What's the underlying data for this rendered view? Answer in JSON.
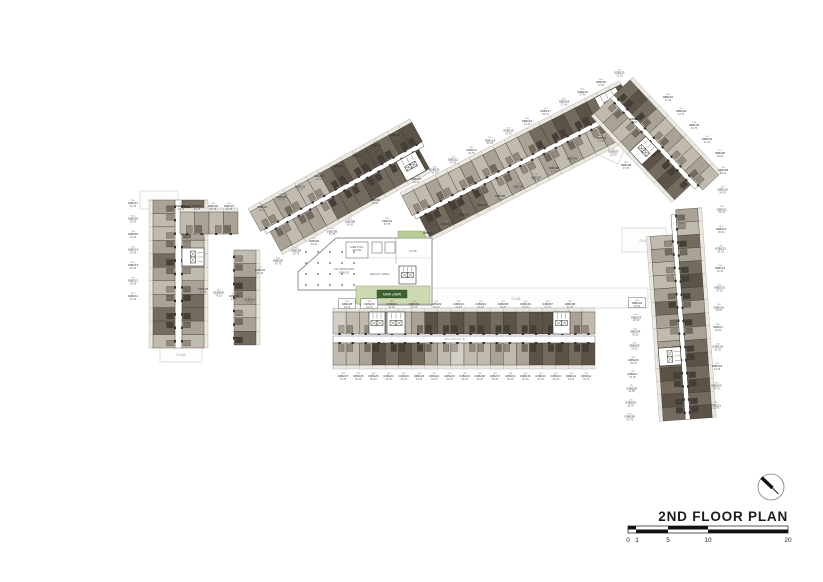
{
  "title": "2ND FLOOR PLAN",
  "scale_bar": {
    "labels": [
      "0",
      "1",
      "5",
      "10",
      "20"
    ]
  },
  "labels": {
    "slab": "SLAB",
    "meeting_1": "MEETING",
    "meeting_2": "ROOM",
    "coworking_1": "CO-WORKING",
    "coworking_2": "SPACE",
    "relax": "RELAX AREA",
    "gym": "GYM",
    "main_lawn": "MAIN LAWN",
    "building_a": "BUILDING A",
    "building_e": "BUILDING E"
  },
  "colors": {
    "unit_palette": [
      "#d3cec6",
      "#c0baaf",
      "#aaa296",
      "#948b7e",
      "#746b5f",
      "#5b5348",
      "#463f37"
    ],
    "walls": "#35302a",
    "balcony": "#ebe8e2",
    "site_line": "#d2d2d2",
    "lawn_fill": "#cdd9b0",
    "lawn_border": "#a3b183",
    "lawn_label_bg": "#3e6134",
    "planter": "#b9cc97",
    "label_text": "#2f2f2f"
  },
  "units": {
    "a_left": [
      {
        "t": "2Bd",
        "no": "01B217",
        "a": "50.75"
      },
      {
        "t": "1Bd+",
        "no": "01B216",
        "a": "38.30"
      },
      {
        "t": "1Bd",
        "no": "01B215",
        "a": "34.25"
      },
      {
        "t": "1Bd",
        "no": "01B214",
        "a": "34.25"
      },
      {
        "t": "1Bd+",
        "no": "01B213",
        "a": "36.30"
      },
      {
        "t": "1Bd",
        "no": "01B212",
        "a": "34.25"
      },
      {
        "t": "1Bd+",
        "no": "01B211",
        "a": "41.40"
      }
    ],
    "a_top": [
      {
        "t": "1Bc",
        "no": "01B218",
        "a": "26.25"
      },
      {
        "t": "1Bc",
        "no": "01B219",
        "a": "26.25"
      },
      {
        "t": "1Bd",
        "no": "01B220",
        "a": "34.75"
      },
      {
        "t": "1Bd",
        "no": "01B221",
        "a": "34.75"
      }
    ],
    "a_inner": [
      {
        "t": "1Bc",
        "no": "01B207",
        "a": "24.75"
      },
      {
        "t": "1Bd",
        "no": "01B208",
        "a": "34.25"
      },
      {
        "t": "1Bd",
        "no": "01B209",
        "a": "34.25"
      },
      {
        "t": "1Bd+",
        "no": "01B210",
        "a": "41.40"
      }
    ],
    "w1_top": [
      {
        "t": "1Bc",
        "no": "01B222",
        "a": "26.25"
      },
      {
        "t": "1Bd",
        "no": "01B223",
        "a": "34.75"
      },
      {
        "t": "1Bd",
        "no": "01B224",
        "a": "34.75"
      },
      {
        "t": "1Bd",
        "no": "01B225",
        "a": "34.75"
      },
      {
        "t": "1Bd",
        "no": "01B226",
        "a": "34.75"
      },
      {
        "t": "1Bd+",
        "no": "01B227",
        "a": "37.40"
      },
      {
        "t": "1Bd+",
        "no": "01B228",
        "a": "37.40"
      },
      {
        "t": "1Bc",
        "no": "01B229",
        "a": "31.30"
      }
    ],
    "w1_tip": [
      {
        "t": "1Bd+",
        "no": "01B230",
        "a": "41.50"
      },
      {
        "t": "2Bd",
        "no": "01B231",
        "a": "50.75"
      }
    ],
    "w1_bottom": [
      {
        "t": "1Bc",
        "no": "01B201",
        "a": "31.30"
      },
      {
        "t": "1Bd",
        "no": "01B202",
        "a": "34.75"
      },
      {
        "t": "1Bd",
        "no": "01B203",
        "a": "34.75"
      },
      {
        "t": "1Bc",
        "no": "01B204",
        "a": "26.25"
      },
      {
        "t": "1Bd",
        "no": "01B205",
        "a": "34.75"
      },
      {
        "t": "1Bd+",
        "no": "01B206",
        "a": "41.50"
      }
    ],
    "w2_top": [
      {
        "t": "1Bd",
        "no": "02B210",
        "a": "34.75"
      },
      {
        "t": "1Bd",
        "no": "02B211",
        "a": "34.75"
      },
      {
        "t": "1Bd",
        "no": "02B212",
        "a": "34.75"
      },
      {
        "t": "1Bd",
        "no": "02B213",
        "a": "34.75"
      },
      {
        "t": "1Bc",
        "no": "02B214",
        "a": "26.25"
      },
      {
        "t": "1Bd",
        "no": "02B215",
        "a": "34.75"
      },
      {
        "t": "1Bd",
        "no": "02B216",
        "a": "34.75"
      },
      {
        "t": "1Bd",
        "no": "02B217",
        "a": "34.75"
      },
      {
        "t": "1Bd+",
        "no": "02B218",
        "a": "37.40"
      },
      {
        "t": "1Bd+",
        "no": "02B219",
        "a": "37.40"
      },
      {
        "t": "1Bd+",
        "no": "02B220",
        "a": "37.40"
      },
      {
        "t": "1Bc",
        "no": "02B221",
        "a": "31.30"
      }
    ],
    "w2_tip": [
      {
        "t": "1Bd+",
        "no": "02B222",
        "a": "41.50"
      }
    ],
    "w2_bottom": [
      {
        "t": "1Bc",
        "no": "02B201",
        "a": "31.30"
      },
      {
        "t": "1Bd",
        "no": "02B202",
        "a": "34.75"
      },
      {
        "t": "1Bd",
        "no": "02B203",
        "a": "34.75"
      },
      {
        "t": "1Bc",
        "no": "02B204",
        "a": "26.25"
      },
      {
        "t": "1Bc",
        "no": "02B205",
        "a": "26.25"
      },
      {
        "t": "1Bd",
        "no": "02B206",
        "a": "34.75"
      },
      {
        "t": "1Bd",
        "no": "02B207",
        "a": "34.75"
      },
      {
        "t": "1Bd+",
        "no": "02B208",
        "a": "41.50"
      },
      {
        "t": "2Bd",
        "no": "02B209",
        "a": "47.25"
      }
    ],
    "w3_ne": [
      {
        "t": "1Bd+",
        "no": "03B201",
        "a": "37.40"
      },
      {
        "t": "1Bd",
        "no": "03B202",
        "a": "34.75"
      },
      {
        "t": "1Bd",
        "no": "03B203",
        "a": "34.75"
      },
      {
        "t": "1Bc",
        "no": "03B204",
        "a": "31.30"
      },
      {
        "t": "1Bc",
        "no": "03B205",
        "a": "26.25"
      }
    ],
    "w3_sw": [
      {
        "t": "1Bd",
        "no": "03B206",
        "a": "34.25"
      },
      {
        "t": "1Bc",
        "no": "03B207",
        "a": "26.25"
      },
      {
        "t": "2Bd",
        "no": "03B208",
        "a": "47.25"
      }
    ],
    "w4_right": [
      {
        "t": "1Bd",
        "no": "03B209",
        "a": "34.25"
      },
      {
        "t": "1Bd",
        "no": "03B210",
        "a": "34.25"
      },
      {
        "t": "1Bd",
        "no": "03B211",
        "a": "34.25"
      },
      {
        "t": "1Bd+",
        "no": "03B212",
        "a": "36.30"
      },
      {
        "t": "1Bd",
        "no": "03B213",
        "a": "34.25"
      },
      {
        "t": "1Bd",
        "no": "03B214",
        "a": "34.25"
      },
      {
        "t": "1Bd",
        "no": "03B215",
        "a": "34.25"
      },
      {
        "t": "1Bd",
        "no": "03B216",
        "a": "34.25"
      },
      {
        "t": "1Bd+",
        "no": "03B217",
        "a": "36.30"
      },
      {
        "t": "1Bd",
        "no": "03B218",
        "a": "34.25"
      },
      {
        "t": "1Bd",
        "no": "03B219",
        "a": "34.25"
      },
      {
        "t": "1Bd",
        "no": "03B220",
        "a": "34.75"
      },
      {
        "t": "1Bd+",
        "no": "03B221",
        "a": "41.75"
      }
    ],
    "w4_left": [
      {
        "t": "2Bd",
        "no": "03B222",
        "a": "54.50",
        "b": true
      },
      {
        "t": "1Bd+",
        "no": "03B223",
        "a": "36.30"
      },
      {
        "t": "1Bd",
        "no": "03B224",
        "a": "34.25"
      },
      {
        "t": "1Bd",
        "no": "03B225",
        "a": "34.25"
      },
      {
        "t": "1Bd+",
        "no": "03B226",
        "a": "36.30"
      },
      {
        "t": "1Bd",
        "no": "03B227",
        "a": "34.25"
      },
      {
        "t": "1Bc",
        "no": "03B228",
        "a": "26.25"
      },
      {
        "t": "1Bd",
        "no": "03B229",
        "a": "34.25"
      },
      {
        "t": "1Bd+",
        "no": "03B230",
        "a": "41.75"
      }
    ],
    "e_top": [
      {
        "t": "1Bd",
        "no": "04B228",
        "a": "34.25",
        "b": true
      },
      {
        "t": "1Bd",
        "no": "04B229",
        "a": "34.75",
        "b": true
      },
      {
        "t": "1Bd",
        "no": "04B230",
        "a": "34.25"
      },
      {
        "t": "1Bd",
        "no": "04B231",
        "a": "35.25"
      },
      {
        "t": "1Bd",
        "no": "04B232",
        "a": "34.25"
      },
      {
        "t": "1Bd",
        "no": "04B233",
        "a": "34.25"
      },
      {
        "t": "1Bd",
        "no": "04B234",
        "a": "34.25"
      },
      {
        "t": "1Bd",
        "no": "04B235",
        "a": "34.25"
      },
      {
        "t": "1Bd",
        "no": "04B236",
        "a": "34.25"
      },
      {
        "t": "2Bd",
        "no": "04B237",
        "a": "61.75"
      },
      {
        "t": "2Bd",
        "no": "04B238",
        "a": "61.75"
      }
    ],
    "e_bottom": [
      {
        "t": "1Bd",
        "no": "04B227",
        "a": "34.75"
      },
      {
        "t": "1Bd",
        "no": "04B226",
        "a": "35.25"
      },
      {
        "t": "1Bd",
        "no": "04B225",
        "a": "35.25"
      },
      {
        "t": "1Bd",
        "no": "04B224",
        "a": "35.25"
      },
      {
        "t": "1Bd",
        "no": "04B223",
        "a": "35.25"
      },
      {
        "t": "1Bd",
        "no": "04B222",
        "a": "34.50"
      },
      {
        "t": "1Bd",
        "no": "04B221",
        "a": "34.25"
      },
      {
        "t": "1Bd",
        "no": "04B220",
        "a": "34.25"
      },
      {
        "t": "1Bd",
        "no": "04B219",
        "a": "34.25"
      },
      {
        "t": "1Bd",
        "no": "04B218",
        "a": "35.25"
      },
      {
        "t": "1Bd",
        "no": "04B217",
        "a": "35.25"
      },
      {
        "t": "1Bd",
        "no": "04B216",
        "a": "35.25"
      },
      {
        "t": "1Bd",
        "no": "04B215",
        "a": "34.25"
      },
      {
        "t": "1Bd",
        "no": "04B214",
        "a": "34.25"
      },
      {
        "t": "1Bd",
        "no": "04B213",
        "a": "34.25"
      },
      {
        "t": "1Bd",
        "no": "04B212",
        "a": "34.50"
      },
      {
        "t": "1Bd",
        "no": "04B211",
        "a": "34.75"
      }
    ]
  }
}
